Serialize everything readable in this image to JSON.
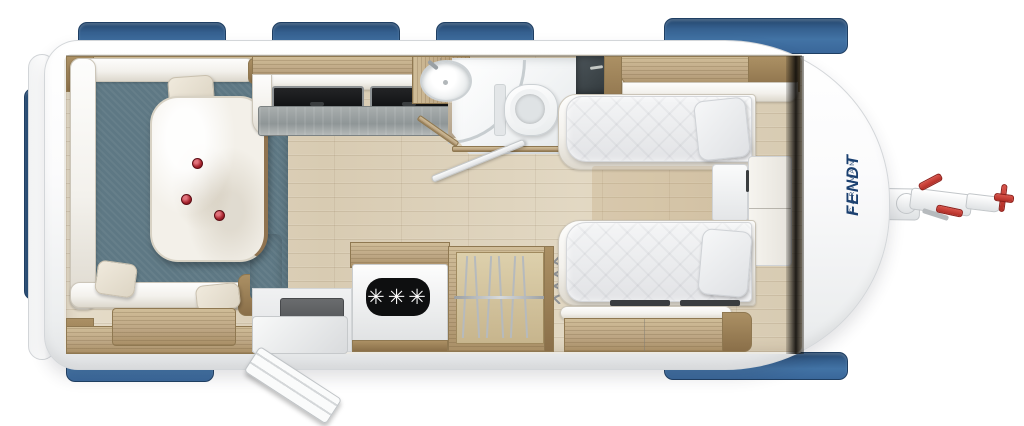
{
  "branding": {
    "brand": "FENDT",
    "series": "CARAVAN"
  },
  "appliances": {
    "freezer_badge": "✳✳✳"
  },
  "colors": {
    "body_white": "#f4f5f6",
    "window_blue": "#3e6da3",
    "wood": "#c0aa84",
    "floor_wood": "#dccfb9",
    "lounge_upholstery": "#5e7884",
    "cushion_cream": "#efe9de",
    "bed_linen": "#e9eaec",
    "counter_grey": "#9aa1a3",
    "freezer_badge_black": "#0e0f10",
    "accent_red": "#c43a31",
    "logo_navy": "#1b4070"
  }
}
